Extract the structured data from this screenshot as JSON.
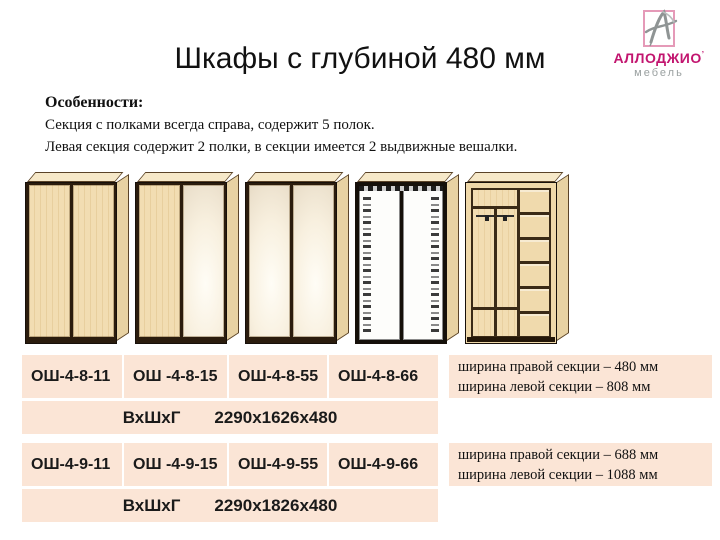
{
  "title": {
    "text": "Шкафы с глубиной 480 мм"
  },
  "logo": {
    "brand": "АЛЛОДЖИО",
    "mark": "’",
    "sub": "мебель",
    "brand_color": "#c2156f",
    "box_border_color": "#e59ab8"
  },
  "features": {
    "heading": "Особенности:",
    "lines": [
      "Секция с полками всегда справа, содержит 5 полок.",
      "Левая  секция содержит 2 полки,  в  секции имеется 2 выдвижные вешалки."
    ]
  },
  "wardrobes": [
    {
      "name": "two-wood-doors"
    },
    {
      "name": "wood-and-mirror-doors"
    },
    {
      "name": "two-mirror-doors"
    },
    {
      "name": "two-ornament-panel-doors"
    },
    {
      "name": "open-interior-shelves-and-rails"
    }
  ],
  "table": {
    "cell_bg": "#fbe5d6",
    "groups": [
      {
        "models": [
          "ОШ-4-8-11",
          "ОШ -4-8-15",
          "ОШ-4-8-55",
          "ОШ-4-8-66"
        ],
        "dims_label": "ВхШхГ",
        "dims_value": "2290х1626х480",
        "note_lines": [
          "ширина  правой секции – 480 мм",
          "ширина левой секции – 808 мм"
        ]
      },
      {
        "models": [
          "ОШ-4-9-11",
          "ОШ -4-9-15",
          "ОШ-4-9-55",
          "ОШ-4-9-66"
        ],
        "dims_label": "ВхШхГ",
        "dims_value": "2290х1826х480",
        "note_lines": [
          "ширина  правой секции – 688 мм",
          "ширина левой секции – 1088 мм"
        ]
      }
    ]
  },
  "colors": {
    "wood": "#f2ddb2",
    "wood_side": "#e8d2a3",
    "frame": "#2b1c0d",
    "peach": "#fbe5d6"
  }
}
